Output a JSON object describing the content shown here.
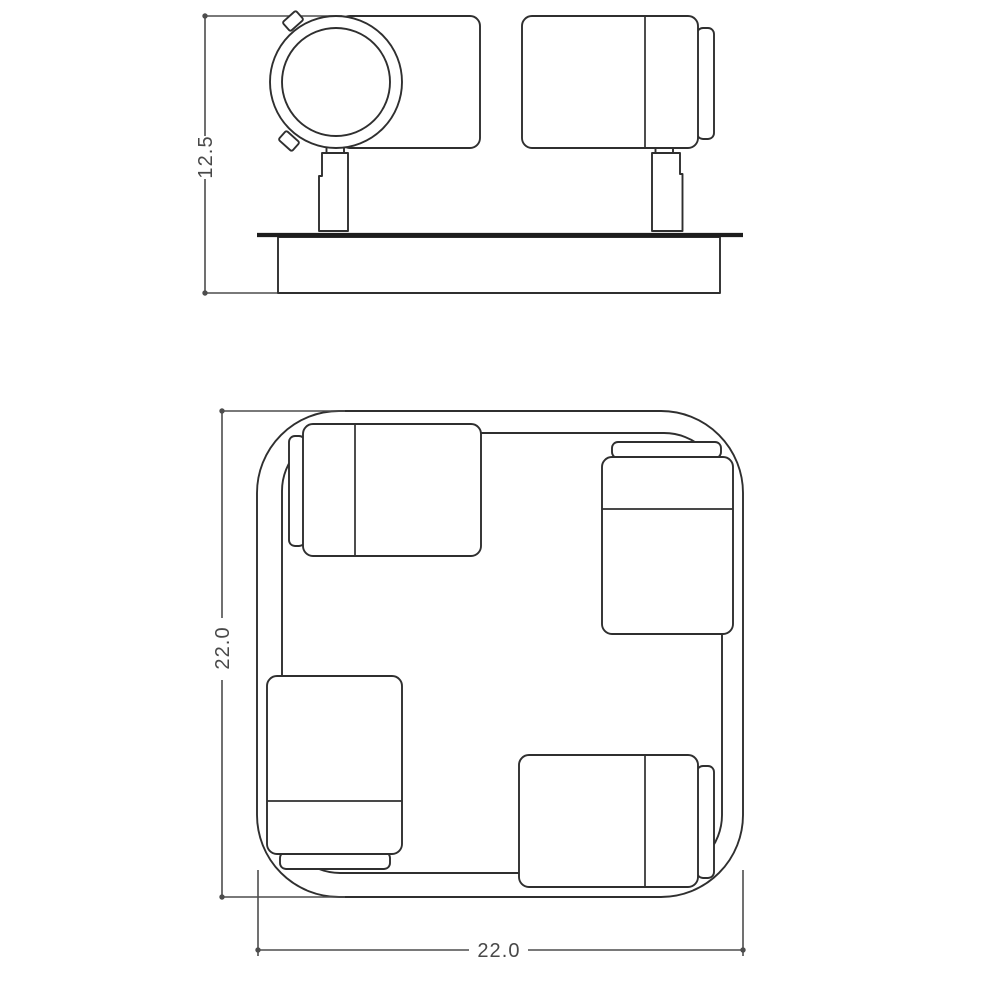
{
  "colors": {
    "background": "#ffffff",
    "line": "#2f2f2f",
    "plate_rim": "#1d1d1d",
    "dimension": "#4d4d4d"
  },
  "side_view": {
    "height_dimension_label": "12.5"
  },
  "plan_view": {
    "side_dimension_label": "22.0",
    "bottom_dimension_label": "22.0"
  }
}
